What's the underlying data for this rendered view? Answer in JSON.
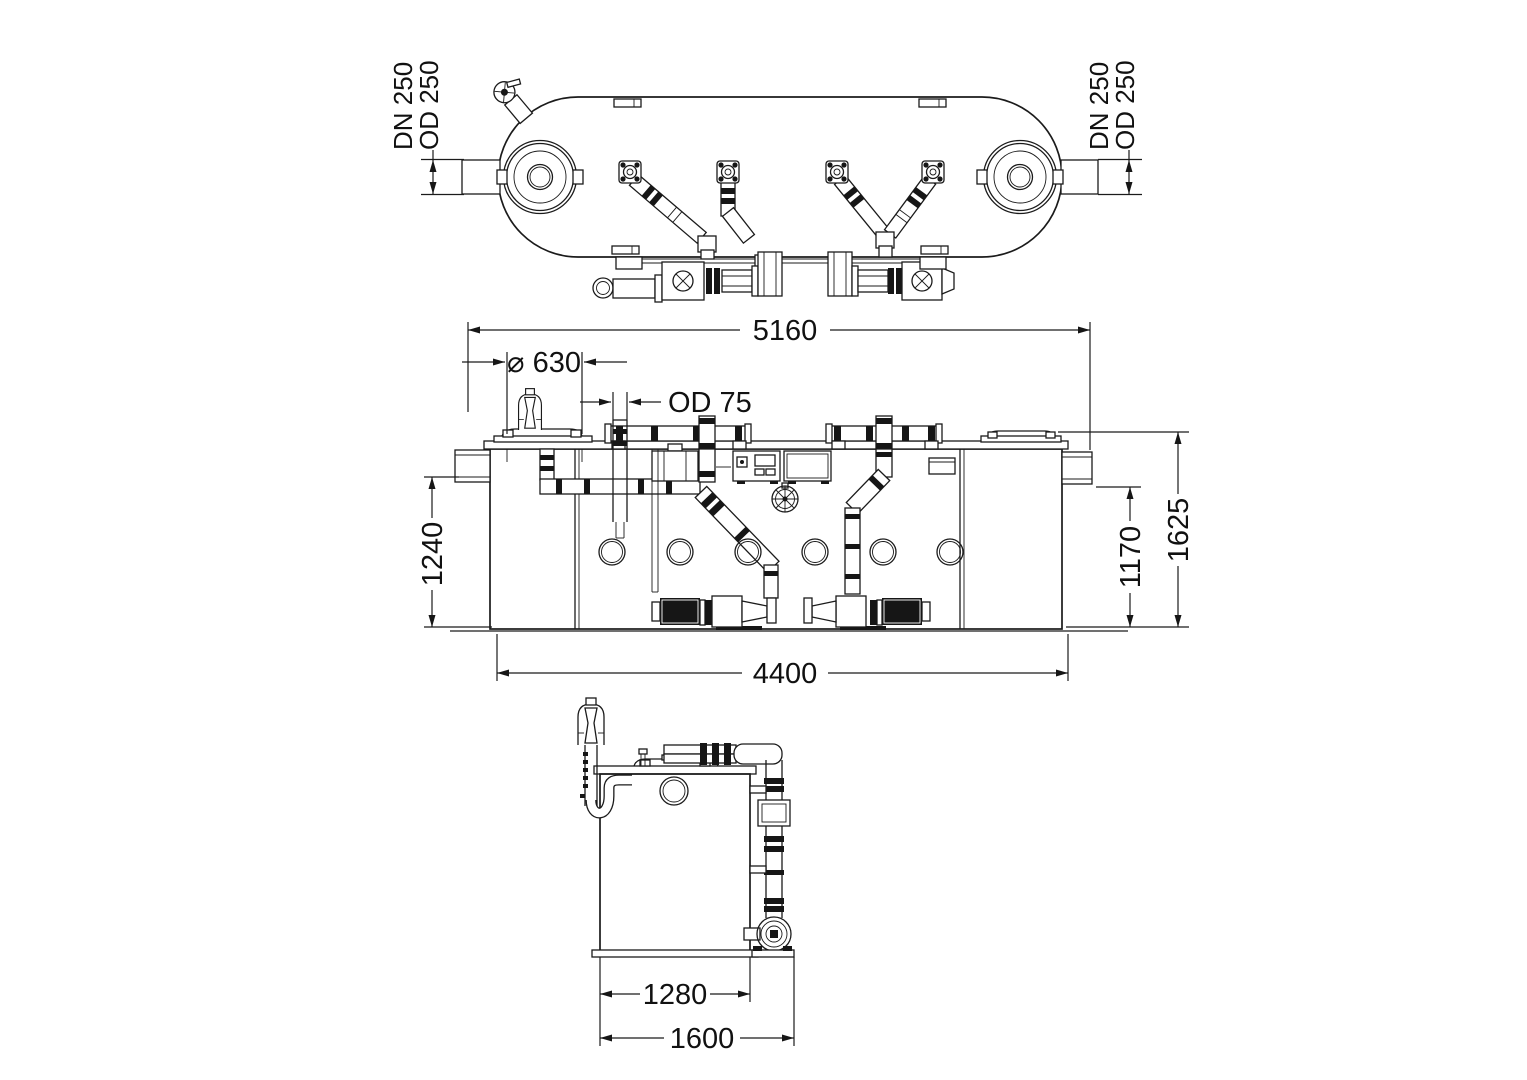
{
  "colors": {
    "line": "#1b1b1b",
    "background": "#ffffff"
  },
  "dims": {
    "plan_left_line1": "DN 250",
    "plan_left_line2": "OD 250",
    "plan_right_line1": "DN 250",
    "plan_right_line2": "OD 250",
    "overall_length": "5160",
    "cover_diameter": "⌀ 630",
    "pipe_od": "OD 75",
    "inlet_height": "1240",
    "outlet_height": "1170",
    "overall_height": "1625",
    "tank_length": "4400",
    "tank_width": "1280",
    "overall_width": "1600"
  }
}
